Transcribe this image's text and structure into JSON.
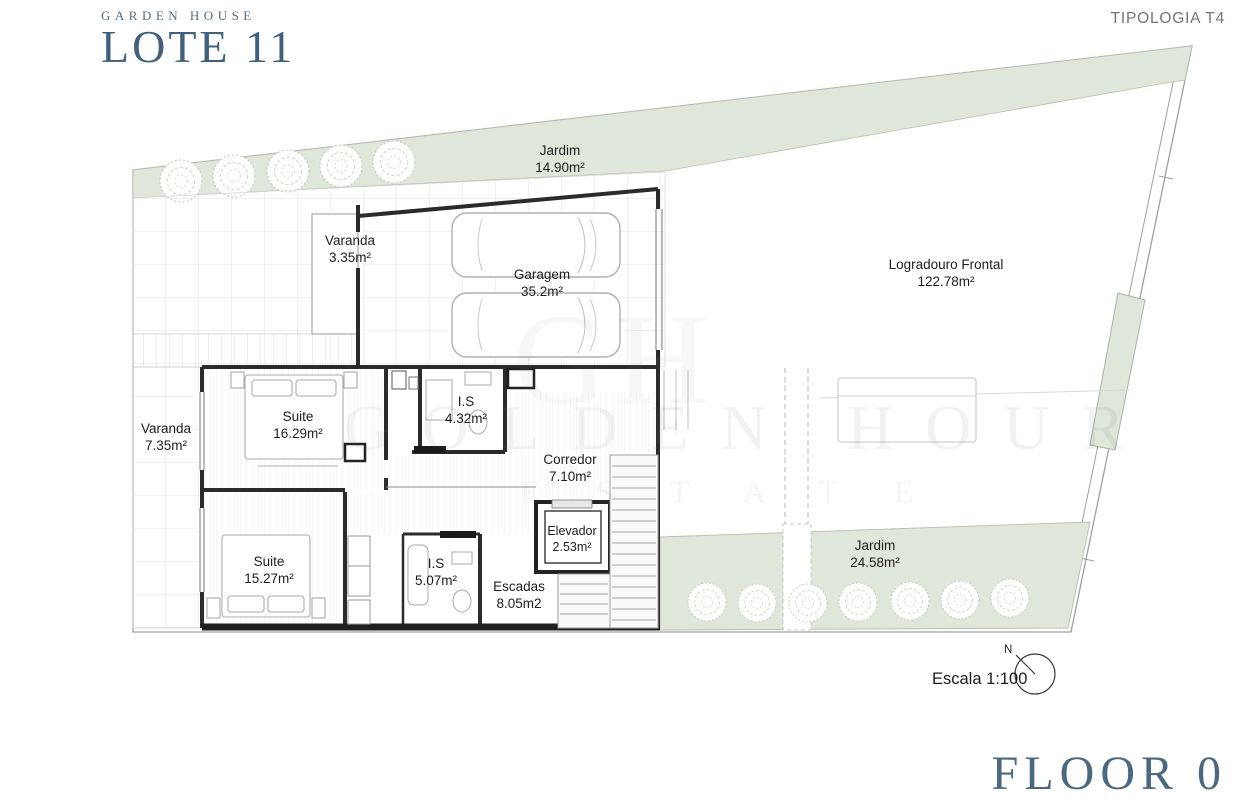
{
  "header": {
    "brand_small": "GARDEN HOUSE",
    "brand_large": "LOTE 11",
    "typology": "TIPOLOGIA T4"
  },
  "rooms": {
    "jardim_top": {
      "name": "Jardim",
      "area": "14.90m²"
    },
    "varanda_top": {
      "name": "Varanda",
      "area": "3.35m²"
    },
    "garagem": {
      "name": "Garagem",
      "area": "35.2m²"
    },
    "logradouro": {
      "name": "Logradouro Frontal",
      "area": "122.78m²"
    },
    "suite_1": {
      "name": "Suite",
      "area": "16.29m²"
    },
    "is_1": {
      "name": "I.S",
      "area": "4.32m²"
    },
    "varanda_left": {
      "name": "Varanda",
      "area": "7.35m²"
    },
    "corredor": {
      "name": "Corredor",
      "area": "7.10m²"
    },
    "elevador": {
      "name": "Elevador",
      "area": "2.53m²"
    },
    "suite_2": {
      "name": "Suite",
      "area": "15.27m²"
    },
    "is_2": {
      "name": "I.S",
      "area": "5.07m²"
    },
    "escadas": {
      "name": "Escadas",
      "area": "8.05m2"
    },
    "jardim_bottom": {
      "name": "Jardim",
      "area": "24.58m²"
    }
  },
  "watermark": {
    "line1": "GOLDEN HOUR",
    "line2": "ESTATE",
    "monogram": "GH"
  },
  "footer": {
    "scale_label": "Escala 1:100",
    "north_label": "N",
    "floor_label": "FLOOR 0"
  },
  "colors": {
    "brand_blue": "#40607b",
    "plan_green": "#dfe6da",
    "wall_dark": "#2b2b2b",
    "typology_gray": "#6d787e"
  }
}
